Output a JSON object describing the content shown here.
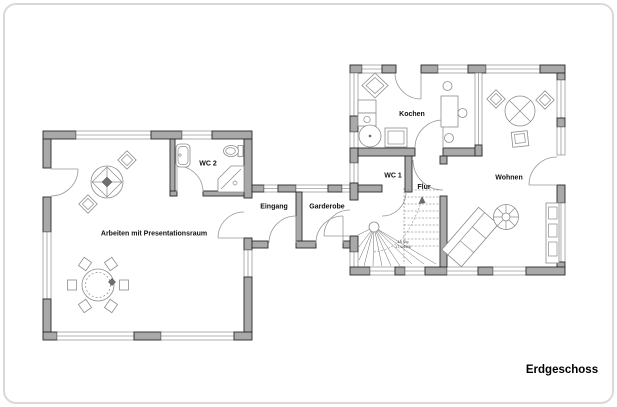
{
  "plan": {
    "title": "Erdgeschoss",
    "rooms": {
      "arbeiten": "Arbeiten mit Presentationsraum",
      "wc2": "WC 2",
      "eingang": "Eingang",
      "garderobe": "Garderobe",
      "wc1": "WC 1",
      "flur": "Flur",
      "kochen": "Kochen",
      "wohnen": "Wohnen"
    },
    "stairs": {
      "line1": "18 Stg",
      "line2": "17,5/28,6"
    },
    "colors": {
      "wall": "#a9a9a9",
      "outline": "#2a2a2a",
      "frame_border": "#d9d9d9",
      "background": "#ffffff"
    }
  }
}
